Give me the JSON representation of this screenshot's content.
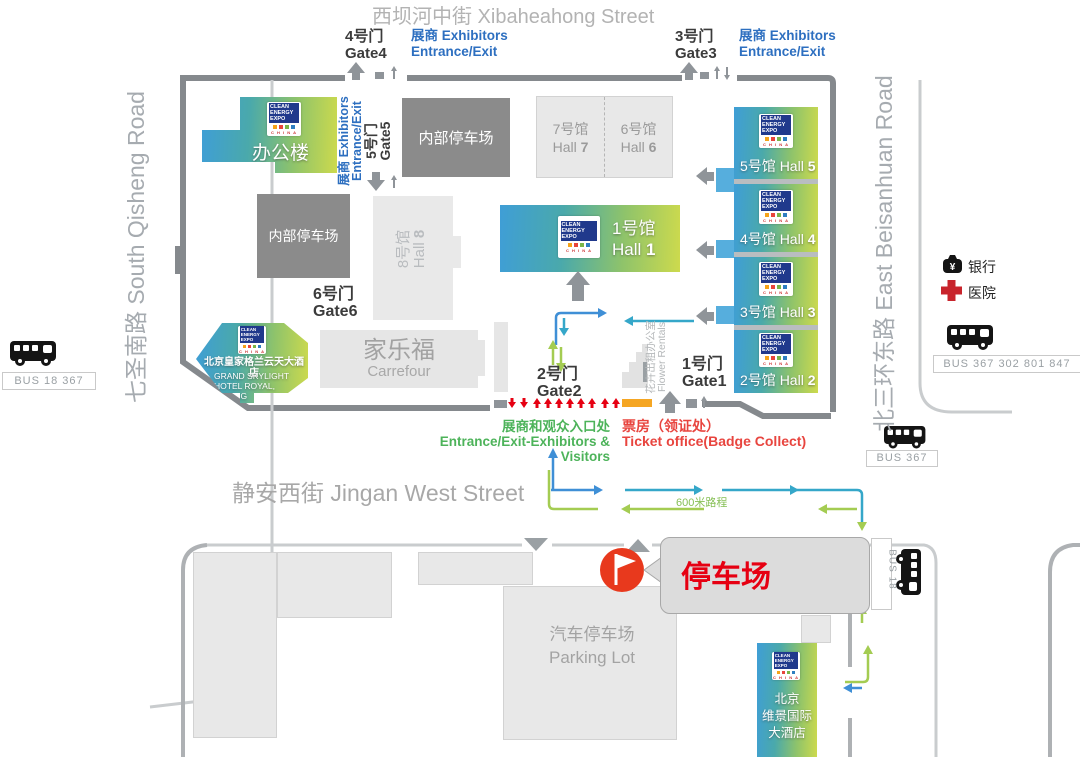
{
  "streets": {
    "top": "西坝河中街  Xibaheahong Street",
    "bottom": "静安西街 Jingan West Street",
    "left": "七圣南路  South Qisheng Road",
    "right": "北三环东路  East Beisanhuan Road"
  },
  "gates": {
    "g1": {
      "cn": "1号门",
      "en": "Gate1"
    },
    "g2": {
      "cn": "2号门",
      "en": "Gate2"
    },
    "g3": {
      "cn": "3号门",
      "en": "Gate3"
    },
    "g4": {
      "cn": "4号门",
      "en": "Gate4"
    },
    "g5": {
      "cn": "5号门",
      "en": "Gate5"
    },
    "g6": {
      "cn": "6号门",
      "en": "Gate6"
    }
  },
  "entrance_exit": {
    "cn": "展商 Exhibitors",
    "en": "Entrance/Exit"
  },
  "halls": {
    "h1": {
      "cn": "1号馆",
      "en": "Hall",
      "num": "1"
    },
    "h2": {
      "cn": "2号馆",
      "en": "Hall",
      "num": "2"
    },
    "h3": {
      "cn": "3号馆",
      "en": "Hall",
      "num": "3"
    },
    "h4": {
      "cn": "4号馆",
      "en": "Hall",
      "num": "4"
    },
    "h5": {
      "cn": "5号馆",
      "en": "Hall",
      "num": "5"
    },
    "h6": {
      "cn": "6号馆",
      "en": "Hall",
      "num": "6"
    },
    "h7": {
      "cn": "7号馆",
      "en": "Hall",
      "num": "7"
    },
    "h8": {
      "cn": "8号馆",
      "en": "Hall",
      "num": "8"
    }
  },
  "buildings": {
    "office": "办公楼",
    "internal_parking": "内部停车场",
    "carrefour_cn": "家乐福",
    "carrefour_en": "Carrefour",
    "flower_cn": "花卉出租办公室",
    "flower_en": "Flower Rentals",
    "car_park_cn": "汽车停车场",
    "car_park_en": "Parking Lot"
  },
  "hotels": {
    "skylight_cn": "北京皇家格兰云天大酒店",
    "skylight_en1": "GRAND SKYLIGHT",
    "skylight_en2": "HOTEL ROYAL, BEIJING",
    "view_l1": "北京",
    "view_l2": "维景国际",
    "view_l3": "大酒店"
  },
  "labels": {
    "entrance_cn": "展商和观众入口处",
    "entrance_en": "Entrance/Exit-Exhibitors & Visitors",
    "ticket_cn": "票房（领证处）",
    "ticket_en": "Ticket office(Badge Collect)",
    "parking_callout": "停车场",
    "distance": "600米路程",
    "bank": "银行",
    "hospital": "医院"
  },
  "bus": {
    "left_stop": "BUS  18  367",
    "legend_stop": "BUS  367  302  801  847",
    "gate_stop": "BUS  367",
    "vertical_stop": "BUS 18"
  },
  "logo": {
    "l1": "CLEAN",
    "l2": "ENERGY",
    "l3": "EXPO",
    "china": "C H I N A"
  },
  "icons": {
    "bus": "bus-icon",
    "bank": "bank-icon",
    "hospital": "red-cross-icon",
    "flag": "flag-marker-icon",
    "arrows": "route-arrow-icons"
  },
  "colors": {
    "accent_blue": "#2d6fc0",
    "route_blue": "#3f8fd6",
    "route_teal": "#35a7c9",
    "route_green": "#a4cc52",
    "text_green": "#4db35a",
    "red": "#e60012",
    "orange": "#f5a623",
    "wall_gray": "#85898d",
    "hall_gradient_start": "#3f9ed6",
    "hall_gradient_end": "#cdda4d"
  }
}
